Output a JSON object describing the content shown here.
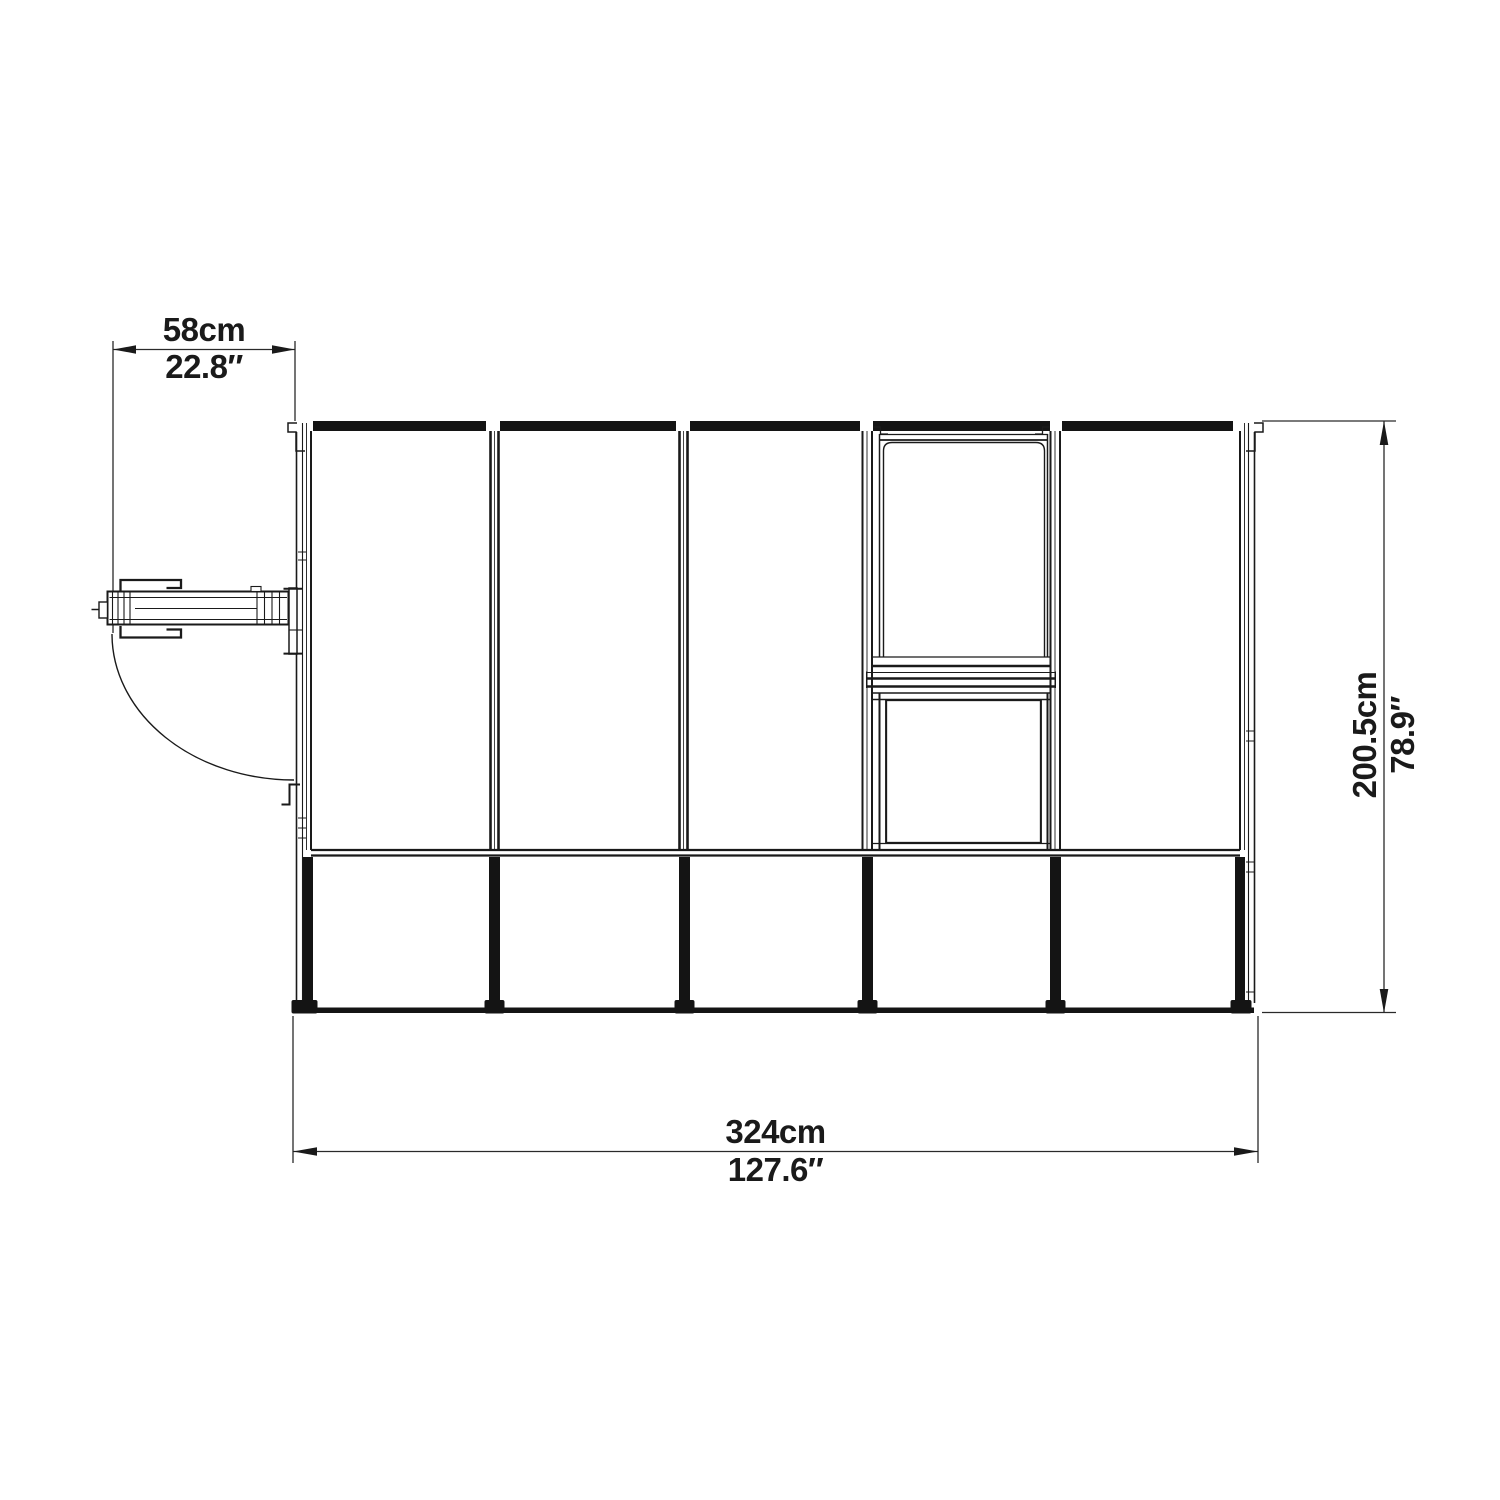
{
  "page": {
    "background": "#ffffff",
    "line_color": "#1a1a1a"
  },
  "dimensions": {
    "door_opening": {
      "metric": "58cm",
      "imperial": "22.8″"
    },
    "overall_width": {
      "metric": "324cm",
      "imperial": "127.6″"
    },
    "overall_depth": {
      "metric": "200.5cm",
      "imperial": "78.9″"
    }
  }
}
